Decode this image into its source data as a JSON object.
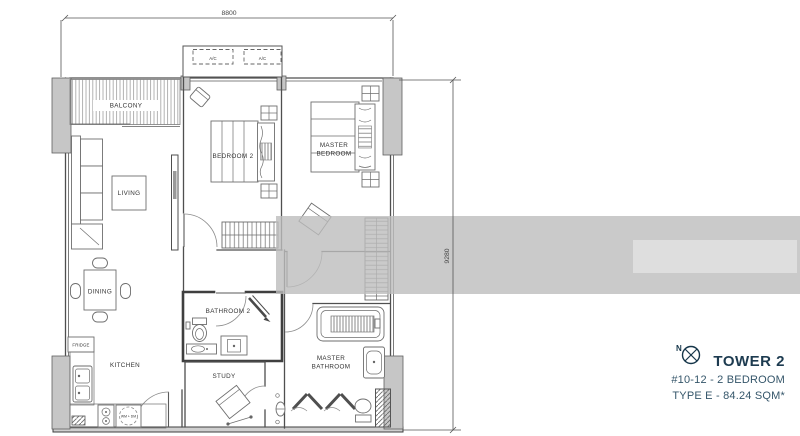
{
  "floor_plan": {
    "dim_width": "8800",
    "dim_height": "9280",
    "ac_unit_1": "A/C",
    "ac_unit_2": "A/C",
    "rooms": {
      "balcony": "BALCONY",
      "living": "LIVING",
      "dining": "DINING",
      "bedroom2": "BEDROOM 2",
      "master_bedroom_line1": "MASTER",
      "master_bedroom_line2": "BEDROOM",
      "kitchen": "KITCHEN",
      "fridge": "FRIDGE",
      "wm_dm": "WM + DM",
      "bathroom2": "BATHROOM 2",
      "study": "STUDY",
      "master_bathroom_line1": "MASTER",
      "master_bathroom_line2": "BATHROOM"
    }
  },
  "title_block": {
    "compass_north": "N",
    "tower": "TOWER 2",
    "unit_info": "#10-12 - 2 BEDROOM",
    "type_info": "TYPE E - 84.24 SQM*"
  },
  "colors": {
    "title": "#1d3b50",
    "subtitle": "#35566a",
    "plan_line": "#4f4f4f",
    "pillar_fill": "#c6c6c6",
    "watermark_band": "#bdbdbd"
  }
}
